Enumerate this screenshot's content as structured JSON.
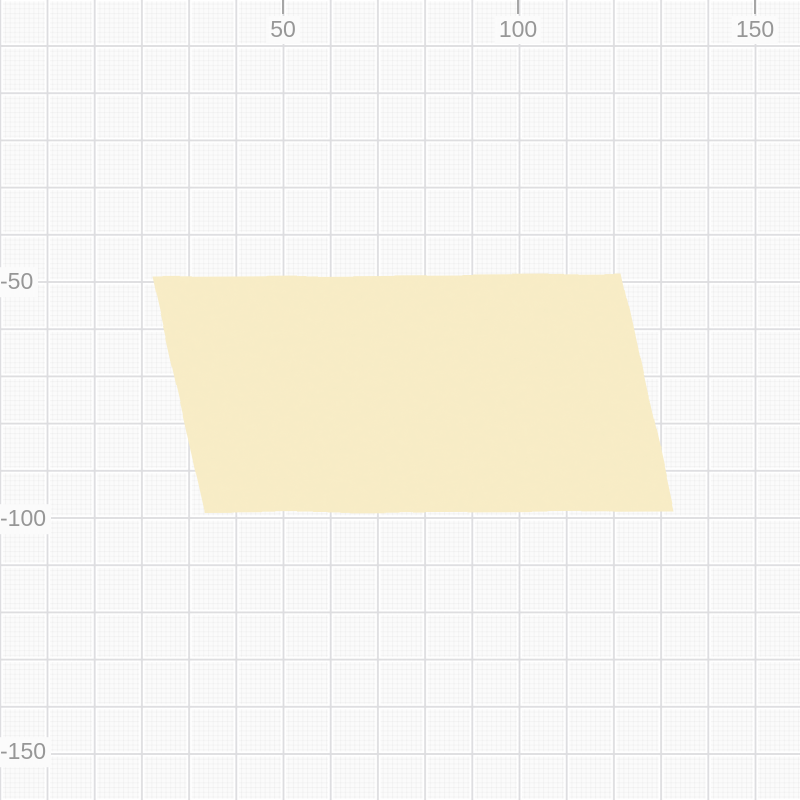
{
  "app": {
    "view": "canvas-grid-viewport"
  },
  "canvas": {
    "width_px": 800,
    "height_px": 800,
    "background_color": "#fbfbfb",
    "grid": {
      "minor_spacing_px": 4.72,
      "major_spacing_px": 47.2,
      "units_per_major_cell": 10,
      "minor_line_color": "rgba(0,0,0,0.028)",
      "major_line_color": "#dddde0",
      "major_halo_color": "#ffffff",
      "origin_screen_px": {
        "x": 47.5,
        "y": 46
      },
      "px_per_unit": 4.72
    }
  },
  "axes": {
    "label_color": "#979797",
    "tick_color": "#a6a6a6",
    "top_ticks": [
      {
        "label": "50",
        "x_px": 283
      },
      {
        "label": "100",
        "x_px": 518
      },
      {
        "label": "150",
        "x_px": 755
      }
    ],
    "left_ticks": [
      {
        "label": "-50",
        "y_px": 282
      },
      {
        "label": "-100",
        "y_px": 519
      },
      {
        "label": "-150",
        "y_px": 752
      }
    ]
  },
  "shape": {
    "kind": "parallelogram",
    "fill_color": "#f8edc7",
    "points_px": [
      [
        152,
        277
      ],
      [
        622,
        274
      ],
      [
        674,
        511
      ],
      [
        205,
        513
      ]
    ],
    "approx_points_units": [
      [
        22,
        -49
      ],
      [
        122,
        -48
      ],
      [
        133,
        -98
      ],
      [
        33,
        -99
      ]
    ]
  }
}
